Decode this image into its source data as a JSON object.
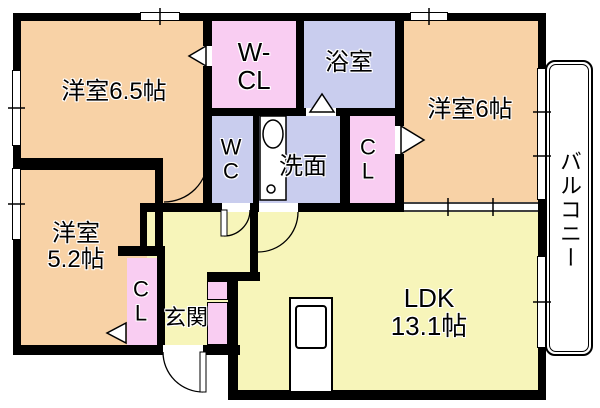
{
  "plan": {
    "rooms": {
      "western65": {
        "label": "洋室6.5帖"
      },
      "wcl": {
        "line1": "W-",
        "line2": "CL"
      },
      "bath": {
        "label": "浴室"
      },
      "western6": {
        "label": "洋室6帖"
      },
      "balcony": {
        "label": "バルコニー"
      },
      "wc": {
        "line1": "W",
        "line2": "C"
      },
      "washroom": {
        "label": "洗面"
      },
      "closet_east": {
        "line1": "C",
        "line2": "L"
      },
      "western52": {
        "line1": "洋室",
        "line2": "5.2帖"
      },
      "closet_west": {
        "line1": "C",
        "line2": "L"
      },
      "entrance": {
        "label": "玄関"
      },
      "ldk": {
        "line1": "LDK",
        "line2": "13.1帖"
      }
    },
    "colors": {
      "room_peach": "#f8d2a6",
      "closet_pink": "#f9cdf2",
      "wet_area_lavender": "#c9cdee",
      "ldk_yellow": "#f7f5ba",
      "wall_black": "#000000",
      "background_white": "#ffffff"
    },
    "symbols": [
      "door-swing-arc",
      "door-triangle",
      "window",
      "washbasin",
      "kitchen-unit",
      "shoe-cabinet"
    ]
  }
}
